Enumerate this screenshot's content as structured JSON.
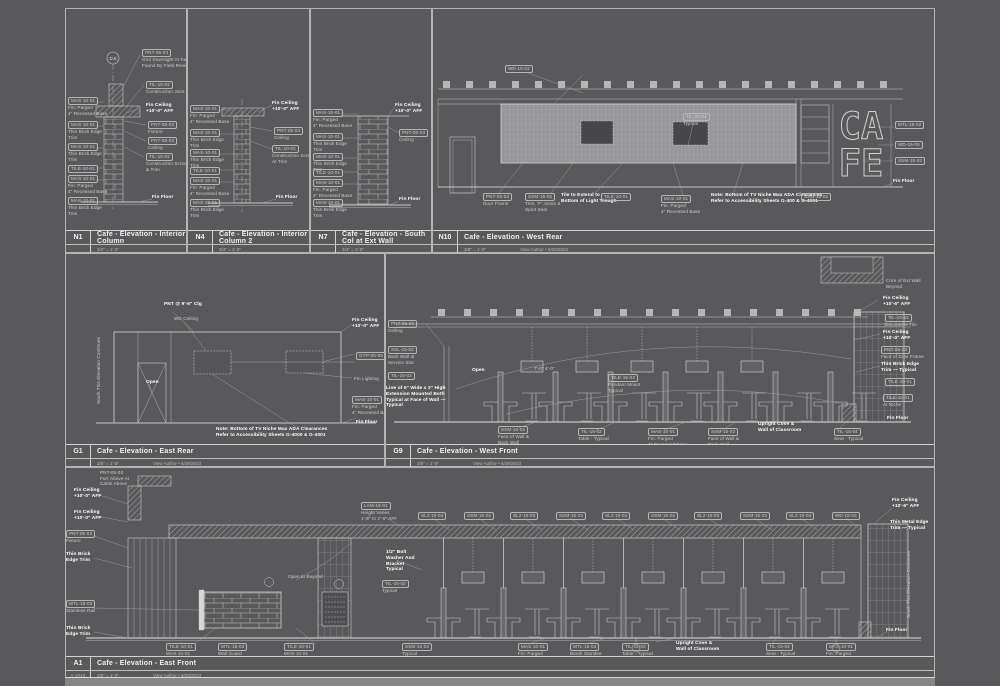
{
  "sheet": {
    "background": "#59595b",
    "line_color": "#c8c8c8",
    "wall_fill": "#97979a",
    "opening_fill": "#47474a",
    "edge_strip_color": "#868686"
  },
  "panels": [
    {
      "id": "N1",
      "title": "Cafe - Elevation - Interior Column",
      "scale": "3/4\" = 1'-0\"",
      "meta": "",
      "meta_left": "",
      "extras": {
        "bubble": "D.6"
      },
      "annotations": [
        {
          "x": 2,
          "y": 88,
          "t": "MAS-10-01\nFin: Parged\n4\" Recessed Base",
          "box": 1
        },
        {
          "x": 2,
          "y": 112,
          "t": "MAS-10-01\nThin Brick Edge\nTrim",
          "box": 1
        },
        {
          "x": 2,
          "y": 134,
          "t": "MAS-10-01\nThin Brick Edge\nTrim",
          "box": 1
        },
        {
          "x": 2,
          "y": 156,
          "t": "TILE-10-01",
          "box": 1
        },
        {
          "x": 2,
          "y": 166,
          "t": "MAS-10-01\nFin: Parged\n4\" Recessed Base",
          "box": 1
        },
        {
          "x": 2,
          "y": 188,
          "t": "MAS-10-01\nThin Brick Edge\nTrim",
          "box": 1
        },
        {
          "x": 76,
          "y": 40,
          "t": "PNT-05-03\nGrid Downlight At Face\nFound By Field Review",
          "box": 1
        },
        {
          "x": 80,
          "y": 72,
          "t": "TIL-10-02\nConstruction Joint",
          "box": 1
        },
        {
          "x": 80,
          "y": 94,
          "t": "Fin Ceiling\n+10'-0\" AFF",
          "b": 1
        },
        {
          "x": 82,
          "y": 112,
          "t": "PNT-05-03\nFixture",
          "box": 1
        },
        {
          "x": 82,
          "y": 128,
          "t": "PNT-05-03\nCeiling",
          "box": 1
        },
        {
          "x": 80,
          "y": 144,
          "t": "TIL-10-02\nConstruction Screed\n& Trim",
          "box": 1
        },
        {
          "x": 86,
          "y": 186,
          "t": "Fin Floor",
          "b": 1
        }
      ]
    },
    {
      "id": "N4",
      "title": "Cafe - Elevation - Interior Column 2",
      "scale": "3/4\" = 1'-0\"",
      "meta": "",
      "meta_left": "",
      "annotations": [
        {
          "x": 2,
          "y": 96,
          "t": "MAS-10-01\nFin: Parged\n4\" Recessed Base",
          "box": 1
        },
        {
          "x": 2,
          "y": 120,
          "t": "MAS-10-01\nThin Brick Edge\nTrim",
          "box": 1
        },
        {
          "x": 2,
          "y": 140,
          "t": "MAS-10-01\nThin Brick Edge\nTrim",
          "box": 1
        },
        {
          "x": 2,
          "y": 158,
          "t": "TILE-10-01",
          "box": 1
        },
        {
          "x": 2,
          "y": 168,
          "t": "MAS-10-01\nFin: Parged\n4\" Recessed Base",
          "box": 1
        },
        {
          "x": 2,
          "y": 190,
          "t": "MAS-10-01\nThin Brick Edge\nTrim",
          "box": 1
        },
        {
          "x": 84,
          "y": 92,
          "t": "Fin Ceiling\n+10'-0\" AFF",
          "b": 1
        },
        {
          "x": 86,
          "y": 118,
          "t": "PNT-05-03\nCeiling",
          "box": 1
        },
        {
          "x": 84,
          "y": 136,
          "t": "TIL-10-02\nConstruction Screed\nAt Trim",
          "box": 1
        },
        {
          "x": 88,
          "y": 186,
          "t": "Fin Floor",
          "b": 1
        }
      ]
    },
    {
      "id": "N7",
      "title": "Cafe - Elevation - South Col at Ext Wall",
      "scale": "3/4\" = 1'-0\"",
      "meta": "",
      "meta_left": "",
      "annotations": [
        {
          "x": 2,
          "y": 100,
          "t": "MAS-10-01\nFin: Parged\n4\" Recessed Base",
          "box": 1
        },
        {
          "x": 2,
          "y": 124,
          "t": "MAS-10-01\nThin Brick Edge\nTrim",
          "box": 1
        },
        {
          "x": 2,
          "y": 144,
          "t": "MAS-10-01\nThin Brick Edge\nTrim",
          "box": 1
        },
        {
          "x": 2,
          "y": 160,
          "t": "TILE-10-01",
          "box": 1
        },
        {
          "x": 2,
          "y": 170,
          "t": "MAS-10-01\nFin: Parged\n4\" Recessed Base",
          "box": 1
        },
        {
          "x": 2,
          "y": 190,
          "t": "MAS-10-01\nThin Brick Edge\nTrim",
          "box": 1
        },
        {
          "x": 84,
          "y": 94,
          "t": "Fin Ceiling\n+10'-0\" AFF",
          "b": 1
        },
        {
          "x": 88,
          "y": 120,
          "t": "PNT-05-03\nCeiling",
          "box": 1
        },
        {
          "x": 88,
          "y": 188,
          "t": "Fin Floor",
          "b": 1
        }
      ]
    },
    {
      "id": "N10",
      "title": "Cafe - Elevation - West Rear",
      "scale": "3/8\" = 1'-0\"",
      "meta": "View Author • 6/29/2023",
      "meta_left": "",
      "extras": {
        "sign1": "CA",
        "sign2": "FE"
      },
      "annotations": [
        {
          "x": 72,
          "y": 56,
          "t": "WD-15-02",
          "box": 1
        },
        {
          "x": 250,
          "y": 104,
          "t": "TIL-10-02\nTypical",
          "box": 1
        },
        {
          "x": 50,
          "y": 184,
          "t": "PNT-05-03\nDoor Frame",
          "box": 1
        },
        {
          "x": 92,
          "y": 184,
          "t": "SSM-15-02\nTrim, 'F' Joints &\nSpirit Seal",
          "box": 1
        },
        {
          "x": 128,
          "y": 184,
          "t": "Tile to Extend to\nBottom of Light Trough",
          "b": 1
        },
        {
          "x": 168,
          "y": 184,
          "t": "TILE-10-01",
          "box": 1
        },
        {
          "x": 228,
          "y": 186,
          "t": "MAS-10-01\nFin: Parged\n4\" Recessed Base",
          "box": 1
        },
        {
          "x": 278,
          "y": 184,
          "t": "Note:  Bottom of TV Niche Max ADA Clearances\nRefer to Accessibility Sheets G-400 & G-4001",
          "b": 1
        },
        {
          "x": 368,
          "y": 184,
          "t": "SSM-15-02",
          "box": 1
        },
        {
          "x": 462,
          "y": 112,
          "t": "MTL-15-02",
          "box": 1
        },
        {
          "x": 462,
          "y": 132,
          "t": "WD-15-05",
          "box": 1
        },
        {
          "x": 462,
          "y": 148,
          "t": "SSM-15-02",
          "box": 1
        },
        {
          "x": 460,
          "y": 170,
          "t": "Fin Floor",
          "b": 1
        }
      ]
    },
    {
      "id": "G1",
      "title": "Cafe - Elevation - East Rear",
      "scale": "3/8\" = 1'-0\"",
      "meta": "View Author • 6/29/2023",
      "meta_left": "",
      "annotations": [
        {
          "x": 98,
          "y": 48,
          "t": "PNT @ 9'-6\" Clg",
          "b": 1
        },
        {
          "x": 108,
          "y": 62,
          "t": "WD Ceiling"
        },
        {
          "x": 80,
          "y": 126,
          "t": "Open",
          "b": 1
        },
        {
          "x": 30,
          "y": 150,
          "t": "South This Elevation Continues",
          "rot": 1
        },
        {
          "x": 286,
          "y": 64,
          "t": "Fin Ceiling\n+10'-0\" AFF",
          "b": 1
        },
        {
          "x": 290,
          "y": 98,
          "t": "GYP-05-05",
          "box": 1
        },
        {
          "x": 288,
          "y": 122,
          "t": "Fin Lighting"
        },
        {
          "x": 286,
          "y": 142,
          "t": "MAS-10-01\nFin: Parged\n4\" Recessed Base",
          "box": 1
        },
        {
          "x": 290,
          "y": 166,
          "t": "Fin Floor",
          "b": 1
        },
        {
          "x": 150,
          "y": 173,
          "t": "Note:  Bottom of TV Niche Max ADA Clearances\nRefer to Accessibility Sheets G-4000 & G-4001",
          "b": 1
        }
      ]
    },
    {
      "id": "G9",
      "title": "Cafe - Elevation - West Front",
      "scale": "3/8\" = 1'-0\"",
      "meta": "View Author • 6/29/2023",
      "meta_left": "",
      "annotations": [
        {
          "x": 2,
          "y": 66,
          "t": "PNT-05-03\nCeiling",
          "box": 1
        },
        {
          "x": 2,
          "y": 92,
          "t": "SSL-15-02\nBack Wall at\nService Slot",
          "box": 1
        },
        {
          "x": 2,
          "y": 118,
          "t": "TIL-15-02",
          "box": 1
        },
        {
          "x": 0,
          "y": 132,
          "t": "Line of 6\" Wide x 3\" High\nExtension Mounted Both\nTypical at Face of Wall —\nTypical",
          "b": 1
        },
        {
          "x": 86,
          "y": 114,
          "t": "Open",
          "b": 1
        },
        {
          "x": 148,
          "y": 112,
          "t": "7'-0\"   4'-0\""
        },
        {
          "x": 222,
          "y": 120,
          "t": "TILE-15-02\nPendant Mount\nTypical",
          "box": 1
        },
        {
          "x": 500,
          "y": 24,
          "t": "Core of Ext Wall\nBeyond"
        },
        {
          "x": 497,
          "y": 42,
          "t": "Fin Ceiling\n+10'-6\" AFF",
          "b": 1
        },
        {
          "x": 499,
          "y": 60,
          "t": "TIL-10-02\nDecorative Tile",
          "box": 1
        },
        {
          "x": 497,
          "y": 76,
          "t": "Fin Ceiling\n+10'-0\" AFF",
          "b": 1
        },
        {
          "x": 495,
          "y": 92,
          "t": "PNT-05-03\nFace of Door Frame",
          "box": 1
        },
        {
          "x": 495,
          "y": 108,
          "t": "Thin Brick Edge\nTrim — Typical",
          "b": 1
        },
        {
          "x": 499,
          "y": 124,
          "t": "TILE-10-01",
          "box": 1
        },
        {
          "x": 497,
          "y": 140,
          "t": "TILE-10-01\nAt Niche",
          "box": 1
        },
        {
          "x": 501,
          "y": 162,
          "t": "Fin Floor",
          "b": 1
        },
        {
          "x": 112,
          "y": 172,
          "t": "SSM-15-02\nFace of Wall &\nBack Wall",
          "box": 1
        },
        {
          "x": 192,
          "y": 174,
          "t": "TIL-15-02\nTable - Typical",
          "box": 1
        },
        {
          "x": 262,
          "y": 174,
          "t": "MAS-10-01\nFin: Parged\n4\" Recessed Base",
          "box": 1
        },
        {
          "x": 322,
          "y": 174,
          "t": "SSM-15-02\nFace of Wall &\nBack Wall",
          "box": 1
        },
        {
          "x": 372,
          "y": 168,
          "t": "Upright Cove &\nWall of Classroom",
          "b": 1
        },
        {
          "x": 448,
          "y": 174,
          "t": "TIL-15-04\nSeat - Typical",
          "box": 1
        }
      ]
    },
    {
      "id": "A1",
      "title": "Cafe - Elevation - East Front",
      "scale": "3/8\" = 1'-0\"",
      "meta": "View Author • 6/29/2023",
      "meta_left": "A-101S",
      "annotations": [
        {
          "x": 34,
          "y": 2,
          "t": "PNT-05-03\nFurr Above At\nCable Above"
        },
        {
          "x": 8,
          "y": 20,
          "t": "Fin Ceiling\n+10'-0\" AFF",
          "b": 1
        },
        {
          "x": 8,
          "y": 42,
          "t": "Fin Ceiling\n+10'-0\" AFF",
          "b": 1
        },
        {
          "x": 0,
          "y": 62,
          "t": "PNT-05-03\nFixture",
          "box": 1
        },
        {
          "x": 0,
          "y": 84,
          "t": "Thin Brick\nEdge Trim",
          "b": 1
        },
        {
          "x": 0,
          "y": 132,
          "t": "MTL-15-02\nStainless Rail",
          "box": 1
        },
        {
          "x": 0,
          "y": 158,
          "t": "Thin Brick\nEdge Trim",
          "b": 1
        },
        {
          "x": 222,
          "y": 106,
          "t": "Open to Beyond"
        },
        {
          "x": 295,
          "y": 34,
          "t": "LAM-15-01\nHeight Varies\n1'-6\" to 2'-6\" AFF",
          "box": 1
        },
        {
          "x": 352,
          "y": 44,
          "t": "SL2-15-04",
          "box": 1
        },
        {
          "x": 398,
          "y": 44,
          "t": "SSM-15-02",
          "box": 1
        },
        {
          "x": 444,
          "y": 44,
          "t": "SL2-15-03",
          "box": 1
        },
        {
          "x": 490,
          "y": 44,
          "t": "SSM-15-02",
          "box": 1
        },
        {
          "x": 536,
          "y": 44,
          "t": "SL2-15-01",
          "box": 1
        },
        {
          "x": 582,
          "y": 44,
          "t": "SSM-15-02",
          "box": 1
        },
        {
          "x": 628,
          "y": 44,
          "t": "SL2-15-03",
          "box": 1
        },
        {
          "x": 674,
          "y": 44,
          "t": "SSM-15-02",
          "box": 1
        },
        {
          "x": 720,
          "y": 44,
          "t": "SL2-15-04",
          "box": 1
        },
        {
          "x": 766,
          "y": 44,
          "t": "WD-15-02",
          "box": 1
        },
        {
          "x": 320,
          "y": 82,
          "t": "1/2\" Bolt\nWasher And\nBracket\nTypical",
          "b": 1
        },
        {
          "x": 316,
          "y": 112,
          "t": "TIL-15-02\nTypical",
          "box": 1
        },
        {
          "x": 826,
          "y": 30,
          "t": "Fin Ceiling\n+10'-6\" AFF",
          "b": 1
        },
        {
          "x": 824,
          "y": 52,
          "t": "Thin Metal Edge\nTrim — Typical",
          "b": 1
        },
        {
          "x": 840,
          "y": 150,
          "t": "South This Elevation Continues",
          "rot": 1
        },
        {
          "x": 820,
          "y": 160,
          "t": "Fin Floor",
          "b": 1
        },
        {
          "x": 100,
          "y": 175,
          "t": "TILE-10-01\nMAS-10-01\n4\" Recessed Base",
          "box": 1
        },
        {
          "x": 152,
          "y": 175,
          "t": "MTL-15-03\nWall Guard",
          "box": 1
        },
        {
          "x": 218,
          "y": 175,
          "t": "TILE-10-01\nMAS-10-01\n4\" Recessed Base",
          "box": 1
        },
        {
          "x": 336,
          "y": 175,
          "t": "SSM-15-02\nTypical",
          "box": 1
        },
        {
          "x": 452,
          "y": 175,
          "t": "MAS-10-01\nFin: Parged\n4\" Recessed Base",
          "box": 1
        },
        {
          "x": 504,
          "y": 175,
          "t": "MTL-15-04\nBooth Standee\nTypical",
          "box": 1
        },
        {
          "x": 556,
          "y": 175,
          "t": "TIL-15-02\nTable - Typical",
          "box": 1
        },
        {
          "x": 610,
          "y": 173,
          "t": "Upright Cove &\nWall of Classroom",
          "b": 1
        },
        {
          "x": 700,
          "y": 175,
          "t": "TIL-15-04\nSeat - Typical",
          "box": 1
        },
        {
          "x": 760,
          "y": 175,
          "t": "MAS-10-01\nFin: Parged\n4\" Recessed Base",
          "box": 1
        }
      ]
    }
  ]
}
